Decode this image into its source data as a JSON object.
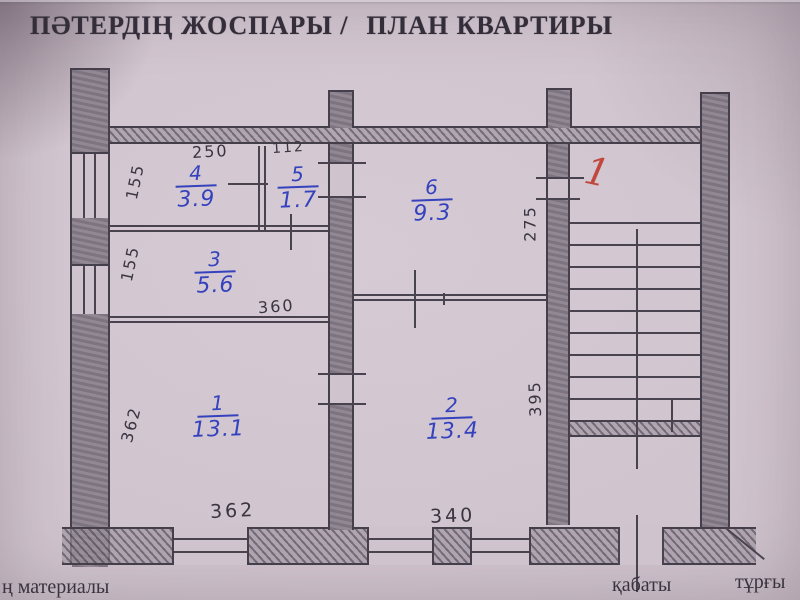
{
  "title": {
    "left": "ПӘТЕРДІҢ ЖОСПАРЫ /",
    "right": "ПЛАН КВАРТИРЫ"
  },
  "plan": {
    "floor_mark": "1",
    "rooms": {
      "r1": {
        "number": "1",
        "area": "13.1"
      },
      "r2": {
        "number": "2",
        "area": "13.4"
      },
      "r3": {
        "number": "3",
        "area": "5.6"
      },
      "r4": {
        "number": "4",
        "area": "3.9"
      },
      "r5": {
        "number": "5",
        "area": "1.7"
      },
      "r6": {
        "number": "6",
        "area": "9.3"
      }
    },
    "dimensions": {
      "top_room4_width": "250",
      "top_room5_width": "112",
      "left_room4_height": "155",
      "left_room3_height": "155",
      "left_room1_height": "362",
      "room3_width": "360",
      "bottom_room1_width": "362",
      "bottom_room2_width": "340",
      "stair_top_height": "275",
      "stair_bottom_height": "395"
    }
  },
  "footer": {
    "materials_label": "ң материалы",
    "floor_label": "қабаты",
    "residence_label": "тұрғы"
  },
  "colors": {
    "paper": "#cfc3cd",
    "pencil": "#453f4c",
    "ink_blue": "#3542bd",
    "ink_red": "#c0473e"
  }
}
